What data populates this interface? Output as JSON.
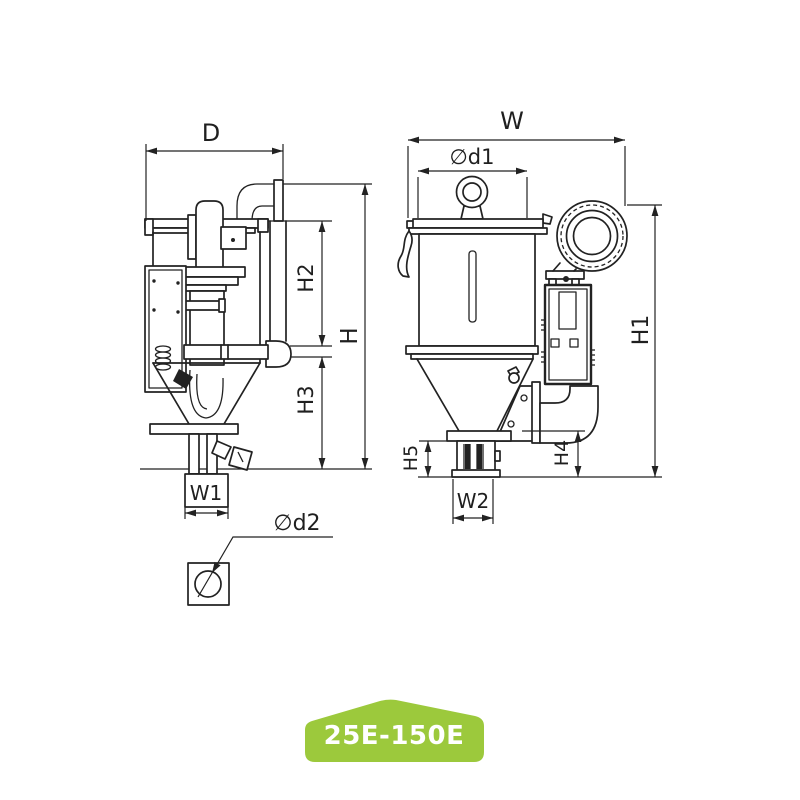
{
  "page": {
    "background_color": "#ffffff"
  },
  "drawing": {
    "line_color": "#222222",
    "dimension_labels": {
      "d": "D",
      "w": "W",
      "d1": "∅d1",
      "d2": "∅d2",
      "h": "H",
      "h1": "H1",
      "h2": "H2",
      "h3": "H3",
      "h4": "H4",
      "h5": "H5",
      "w1": "W1",
      "w2": "W2"
    }
  },
  "badge": {
    "label": "25E-150E",
    "color": "#9cc93c",
    "text_color": "#ffffff"
  }
}
